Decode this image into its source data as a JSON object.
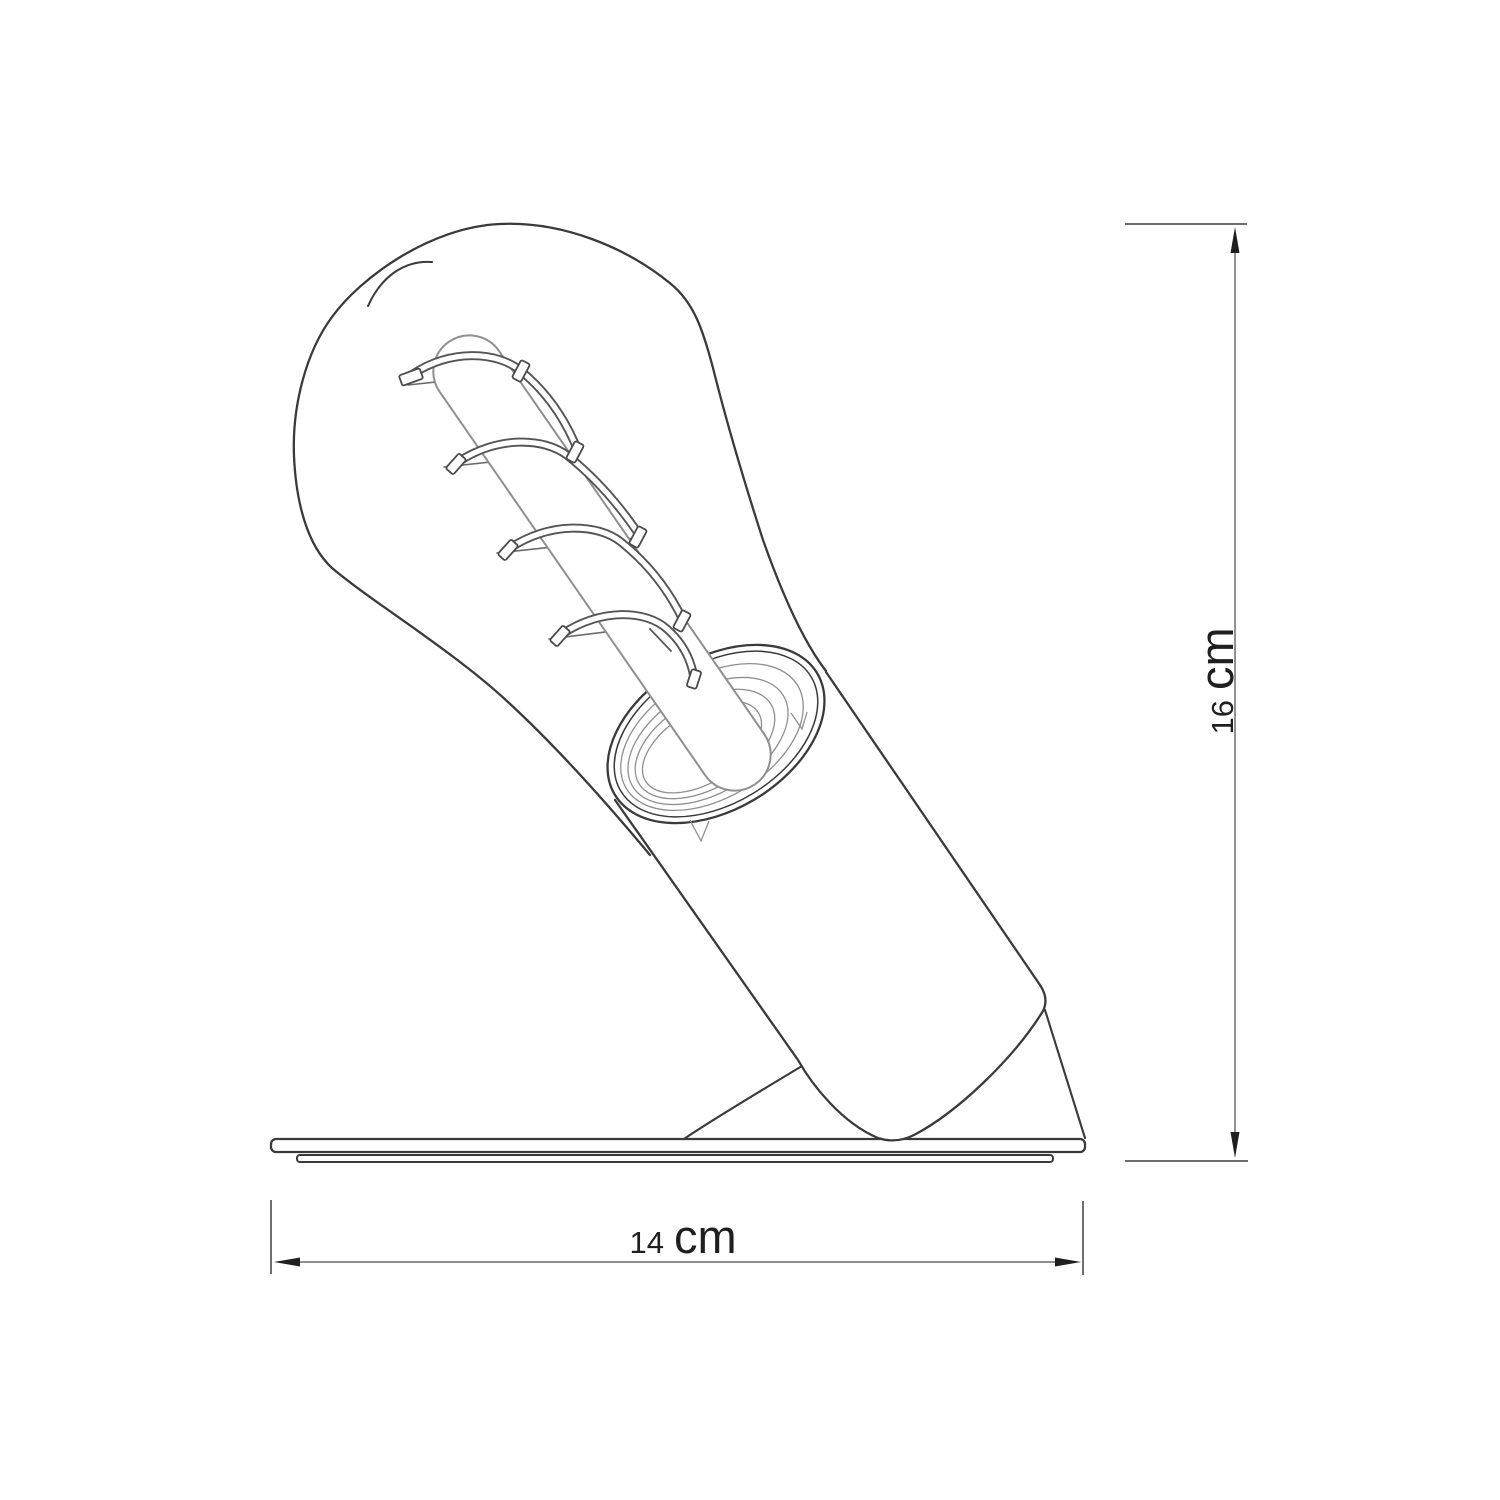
{
  "diagram": {
    "height_dimension": {
      "value": "16",
      "unit": "cm"
    },
    "width_dimension": {
      "value": "14",
      "unit": "cm"
    },
    "colors": {
      "outline": "#3a3a3a",
      "detail_gray": "#8f8f8f",
      "filament_wire": "#6a6a6a",
      "dimension_line": "#7e7e7e",
      "tick_line": "#6f6f6f",
      "arrowhead": "#1f1f1f",
      "label_text": "#1f1f1f",
      "background": "#ffffff"
    }
  }
}
